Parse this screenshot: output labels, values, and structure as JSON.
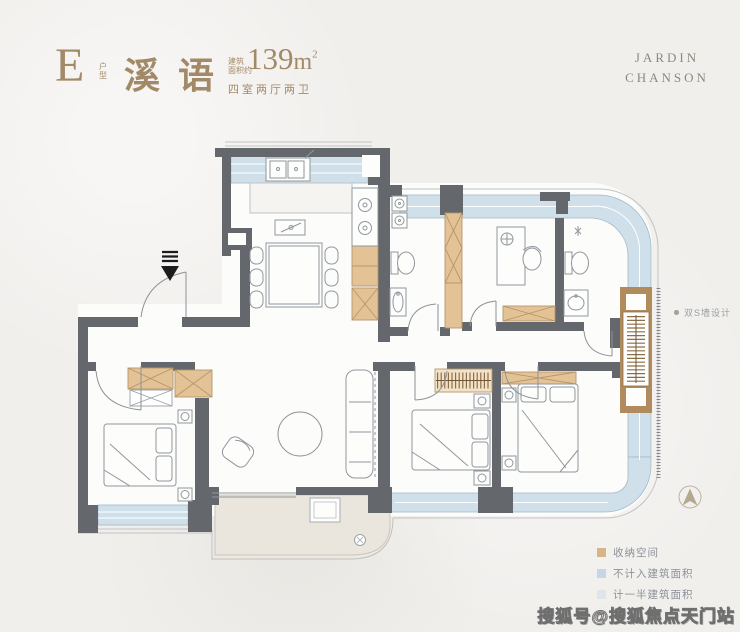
{
  "header": {
    "unit_letter": "E",
    "unit_label": "户型",
    "name": "溪语",
    "area_prefix_line1": "建筑",
    "area_prefix_line2": "面积约",
    "area_value": "139",
    "area_unit": "m",
    "area_sup": "2",
    "layout": "四室两厅两卫"
  },
  "logo": {
    "line1": "JARDIN",
    "line2": "CHANSON"
  },
  "plan": {
    "annotation": "双S墙设计"
  },
  "legend": {
    "items": [
      {
        "label": "收纳空间",
        "color": "#d7b489"
      },
      {
        "label": "不计入建筑面积",
        "color": "#c5d7e4"
      },
      {
        "label": "计一半建筑面积",
        "color": "#dfe6eb"
      }
    ]
  },
  "watermark": "搜狐号@搜狐焦点天门站",
  "colors": {
    "title_gold": "#a28a68",
    "wall": "#64686c",
    "window": "#cfe0ea",
    "storage_tan": "#e3c396",
    "storage_deep": "#b18a5d",
    "terrace": "#eae6dd",
    "background": "#f1efec"
  }
}
